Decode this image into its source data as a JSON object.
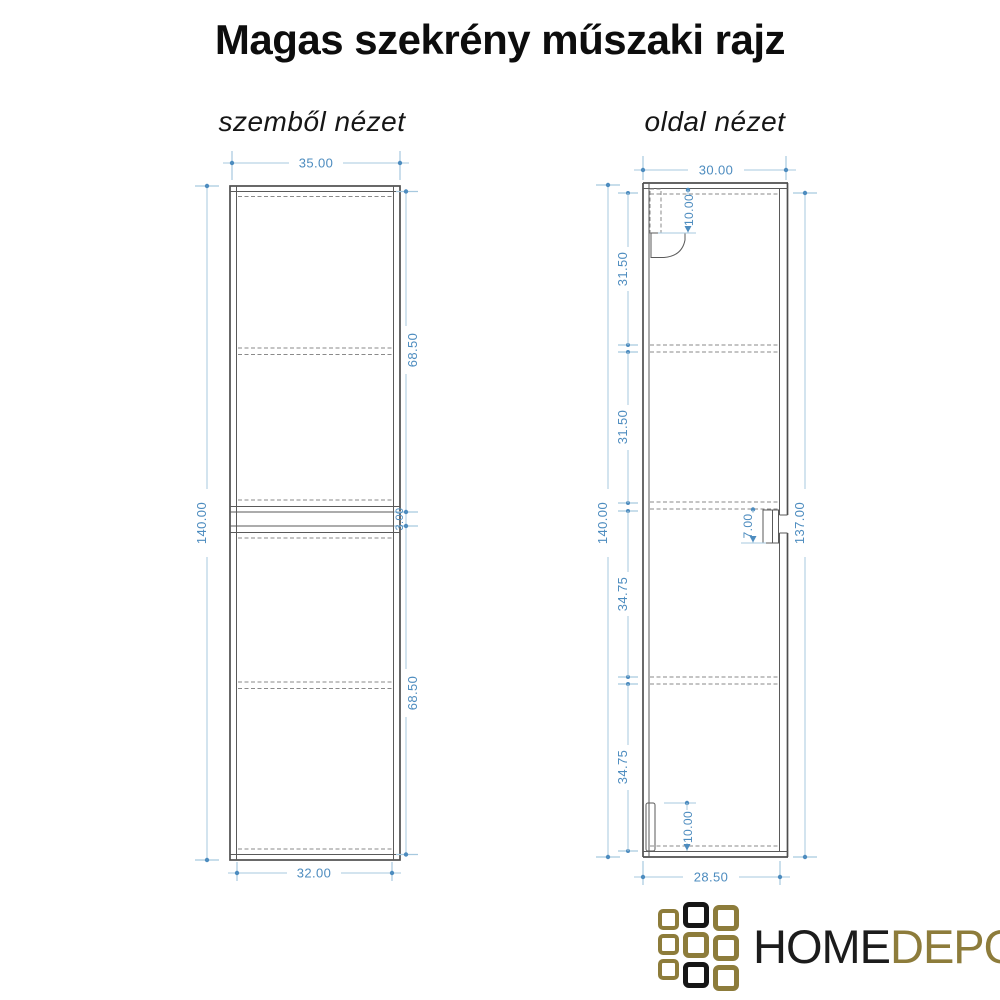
{
  "title": "Magas szekrény műszaki rajz",
  "front_view": {
    "label": "szemből nézet",
    "dimensions": {
      "width_top": "35.00",
      "width_bottom": "32.00",
      "height": "140.00",
      "upper_door_height": "68.50",
      "door_gap": "3.00",
      "lower_door_height": "68.50"
    }
  },
  "side_view": {
    "label": "oldal nézet",
    "dimensions": {
      "depth_top": "30.00",
      "depth_bottom": "28.50",
      "height": "140.00",
      "front_height": "137.00",
      "section_top": "31.50",
      "section_upper_mid": "31.50",
      "section_lower_mid": "34.75",
      "section_bottom": "34.75",
      "bracket_top_offset": "10.00",
      "bracket_bottom_height": "10.00",
      "handle_offset": "7.00"
    }
  },
  "logo": {
    "home": "HOME",
    "depo": "DEPO",
    "grid_pattern": [
      [
        "gold",
        "black",
        "gold"
      ],
      [
        "gold",
        "gold",
        "gold"
      ],
      [
        "gold",
        "black",
        "gold"
      ]
    ],
    "gold_color": "#8d7c3b",
    "black_color": "#161616"
  },
  "colors": {
    "dimension_line": "#a7c9df",
    "dimension_text": "#4d8cbf",
    "drawing_line": "#4f4f4f",
    "hidden_line": "#8a8a8a",
    "background": "#ffffff"
  }
}
